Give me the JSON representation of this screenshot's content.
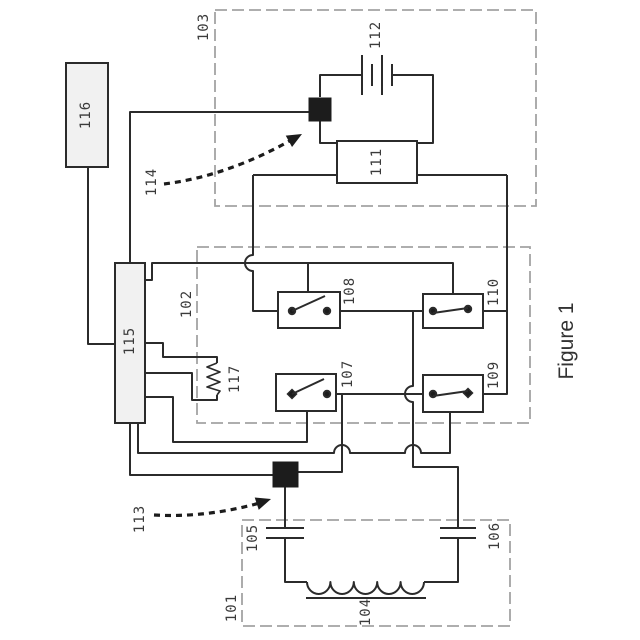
{
  "figure": {
    "caption": "Figure 1"
  },
  "ref_labels": {
    "l101": "101",
    "l102": "102",
    "l103": "103",
    "l104": "104",
    "l105": "105",
    "l106": "106",
    "l107": "107",
    "l108": "108",
    "l109": "109",
    "l110": "110",
    "l111": "111",
    "l112": "112",
    "l113": "113",
    "l114": "114",
    "l115": "115",
    "l116": "116",
    "l117": "117"
  },
  "colors": {
    "wire": "#2b2b2b",
    "dashed_box": "#a3a3a3",
    "component_fill": "#f1f1f1",
    "connector_fill": "#1c1c1c"
  }
}
